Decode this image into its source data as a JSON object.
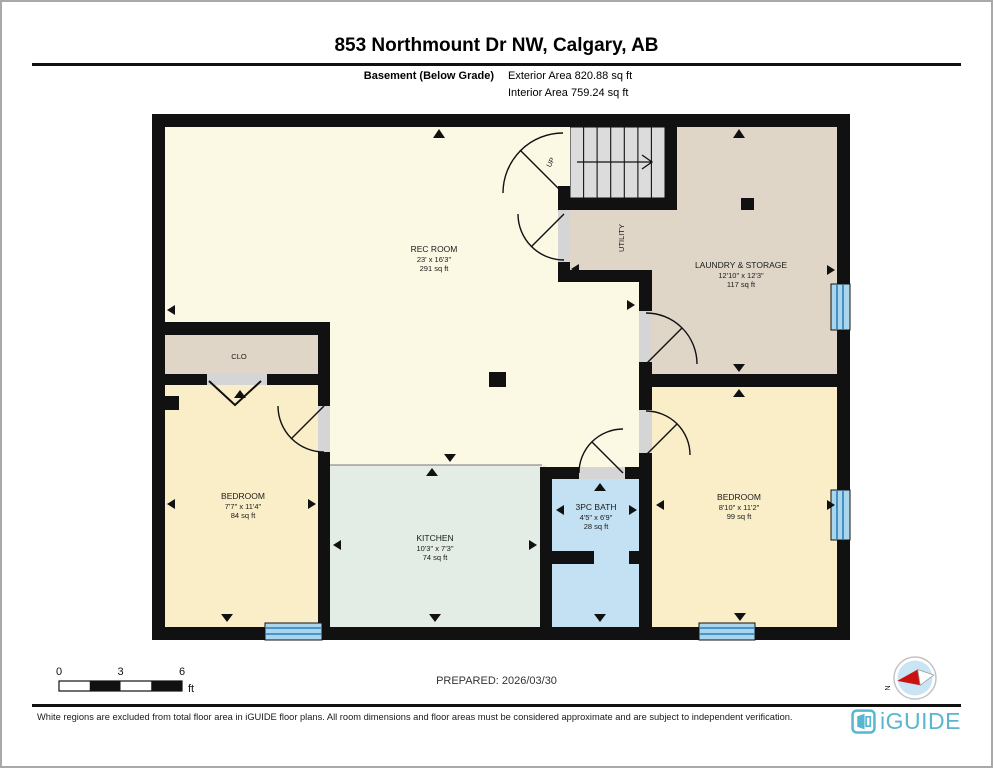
{
  "header": {
    "title": "853 Northmount Dr NW, Calgary, AB",
    "floor_label": "Basement (Below Grade)",
    "exterior_area": "Exterior Area 820.88 sq ft",
    "interior_area": "Interior Area 759.24 sq ft"
  },
  "rooms": {
    "rec": {
      "name": "REC ROOM",
      "dims": "23' x 16'3\"",
      "area": "291 sq ft"
    },
    "laundry": {
      "name": "LAUNDRY & STORAGE",
      "dims": "12'10\" x 12'3\"",
      "area": "117 sq ft"
    },
    "utility": {
      "name": "UTILITY"
    },
    "clo": {
      "name": "CLO"
    },
    "bedroom_left": {
      "name": "BEDROOM",
      "dims": "7'7\" x 11'4\"",
      "area": "84 sq ft"
    },
    "kitchen": {
      "name": "KITCHEN",
      "dims": "10'3\" x 7'3\"",
      "area": "74 sq ft"
    },
    "bath": {
      "name": "3PC BATH",
      "dims": "4'5\" x 6'9\"",
      "area": "28 sq ft"
    },
    "bedroom_right": {
      "name": "BEDROOM",
      "dims": "8'10\" x 11'2\"",
      "area": "99 sq ft"
    },
    "stairs": {
      "label": "UP"
    }
  },
  "scale_bar": {
    "t0": "0",
    "t1": "3",
    "t2": "6",
    "unit": "ft"
  },
  "compass": {
    "north": "N"
  },
  "footer": {
    "prepared": "PREPARED: 2026/03/30",
    "disclaimer": "White regions are excluded from total floor area in iGUIDE floor plans. All room dimensions and floor areas must be considered approximate and are subject to independent verification.",
    "brand": "iGUIDE"
  },
  "colors": {
    "wall": "#111111",
    "rec_cream": "#fbf8e4",
    "bedroom_cream": "#faeec8",
    "tan": "#dfd6c8",
    "kitchen_green": "#e3ede5",
    "bath_blue": "#c3e1f3",
    "stairs_gray": "#dcdcdc",
    "window_blue": "#a9d6ec",
    "brand_teal": "#58b6cf"
  }
}
